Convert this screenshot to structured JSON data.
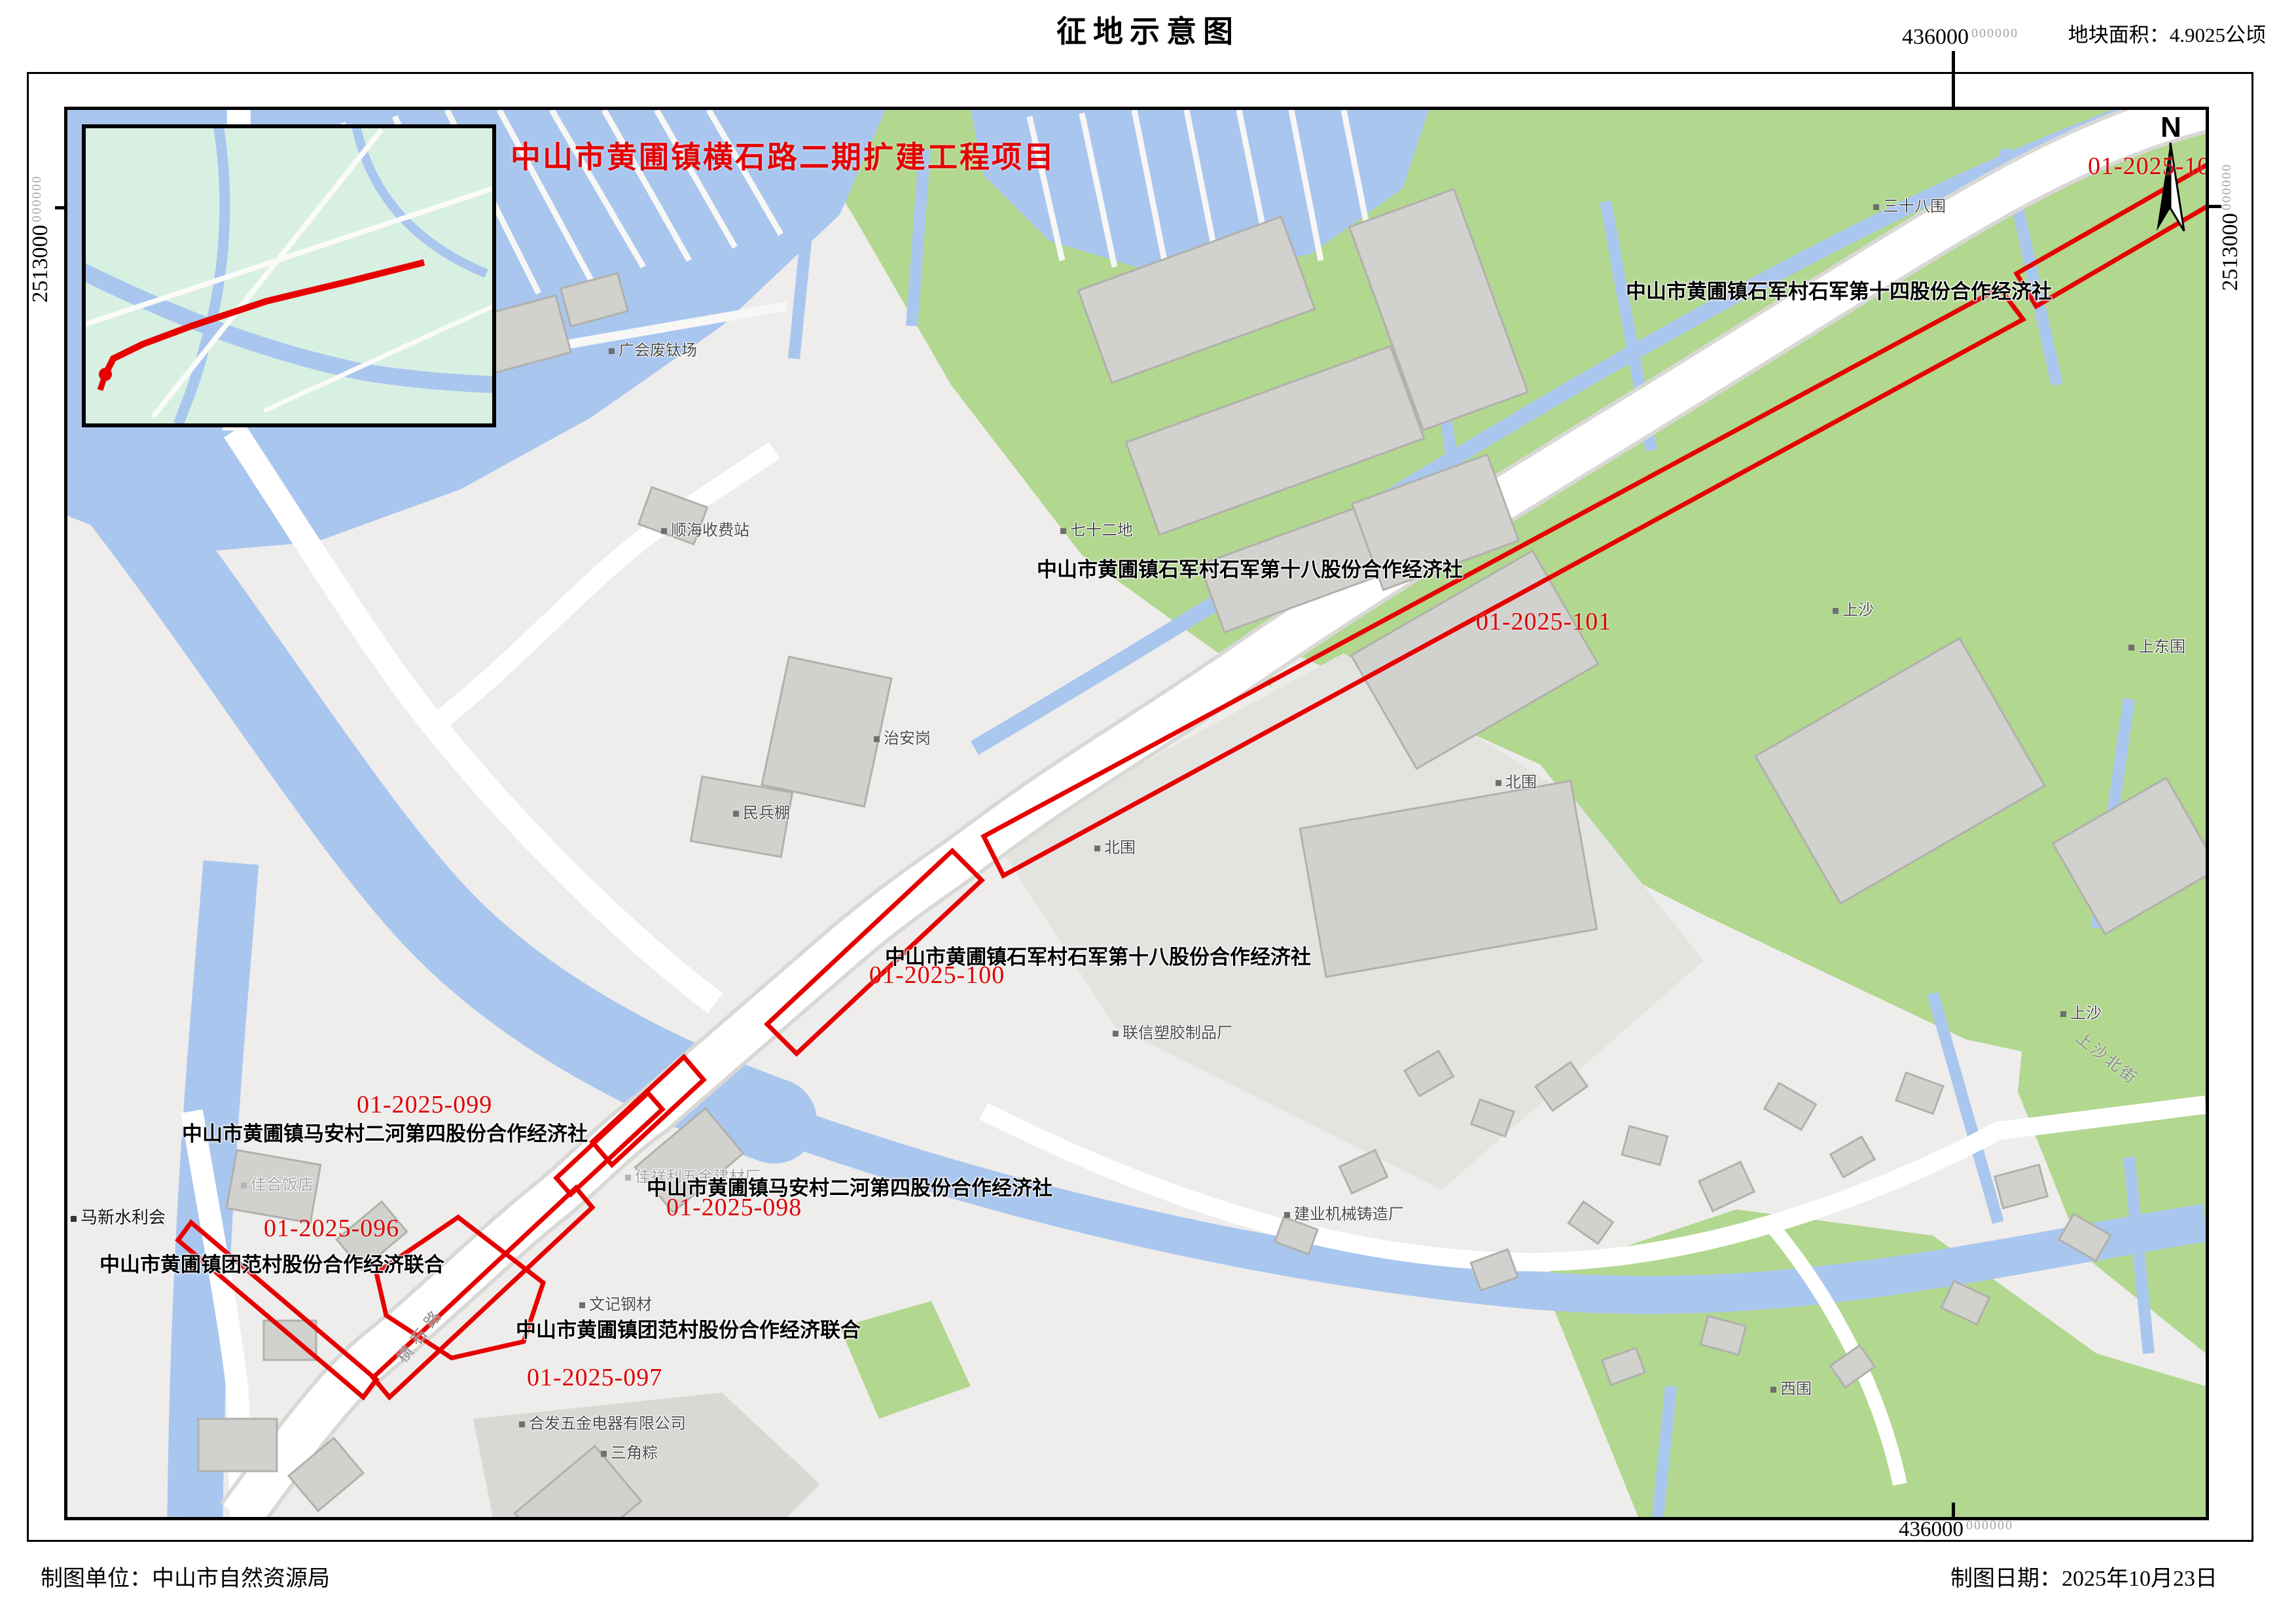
{
  "sheet": {
    "title": "征地示意图",
    "area_note": "地块面积：4.9025公顷",
    "credit_unit": "制图单位：中山市自然资源局",
    "credit_date": "制图日期：2025年10月23日"
  },
  "grid": {
    "x_label": "436000",
    "y_label": "2513000",
    "decimal_suffix": "000000"
  },
  "map": {
    "project_title": "中山市黄圃镇横石路二期扩建工程项目",
    "north": "N",
    "parcels": [
      "01-2025-102",
      "01-2025-101",
      "01-2025-100",
      "01-2025-099",
      "01-2025-098",
      "01-2025-096",
      "01-2025-097"
    ],
    "orgs": [
      "中山市黄圃镇石军村石军第十四股份合作经济社",
      "中山市黄圃镇石军村石军第十八股份合作经济社",
      "中山市黄圃镇石军村石军第十八股份合作经济社",
      "中山市黄圃镇马安村二河第四股份合作经济社",
      "中山市黄圃镇马安村二河第四股份合作经济社",
      "中山市黄圃镇团范村股份合作经济联合",
      "中山市黄圃镇团范村股份合作经济联合"
    ],
    "pois": [
      "广会废钛场",
      "顺海收费站",
      "七十二地",
      "治安岗",
      "民兵棚",
      "北围",
      "北围",
      "上沙",
      "上东围",
      "三十八围",
      "联信塑胶制品厂",
      "建业机械铸造厂",
      "上沙",
      "西围",
      "文记钢材",
      "合发五金电器有限公司",
      "三角粽",
      "佳祥利五金建材厂",
      "佳合饭店",
      "马新水利会"
    ],
    "streets": [
      "横石路",
      "上沙北街"
    ]
  },
  "colors": {
    "red": "#e60000",
    "water": "#a9c6ef",
    "green": "#b2d78f"
  }
}
